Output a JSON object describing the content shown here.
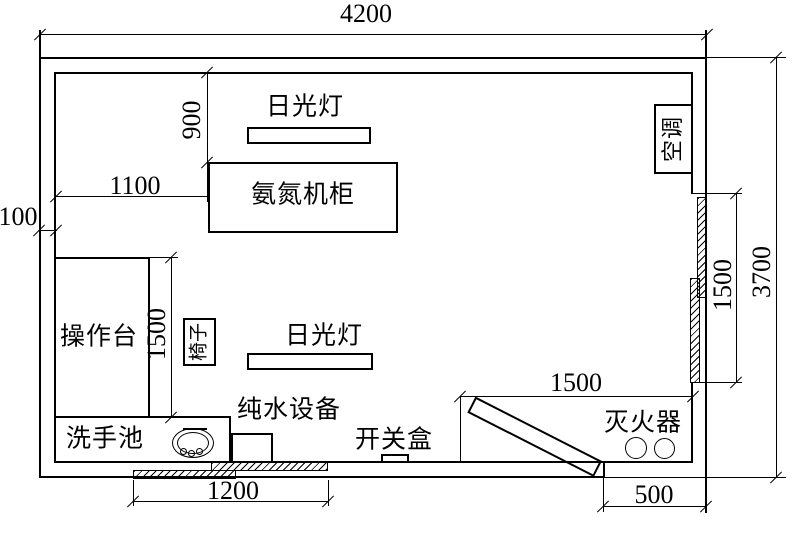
{
  "drawing": {
    "type": "floor-plan",
    "units": "mm",
    "colors": {
      "line": "#000000",
      "background": "#ffffff"
    }
  },
  "dims": {
    "top_width": "4200",
    "right_height": "3700",
    "right_window_length": "1500",
    "lamp_offset_from_wall": "900",
    "cabinet_offset_from_wall": "1100",
    "wall_thickness": "100",
    "table_length": "1500",
    "extinguisher_clearance": "1500",
    "bottom_window_width": "1200",
    "door_width": "500"
  },
  "labels": {
    "lamp_top": "日光灯",
    "cabinet": "氨氮机柜",
    "air_conditioner": "空调",
    "operation_table": "操作台",
    "chair": "椅子",
    "lamp_bottom": "日光灯",
    "pure_water_equipment": "纯水设备",
    "sink": "洗手池",
    "switch_box": "开关盒",
    "fire_extinguisher": "灭火器"
  }
}
